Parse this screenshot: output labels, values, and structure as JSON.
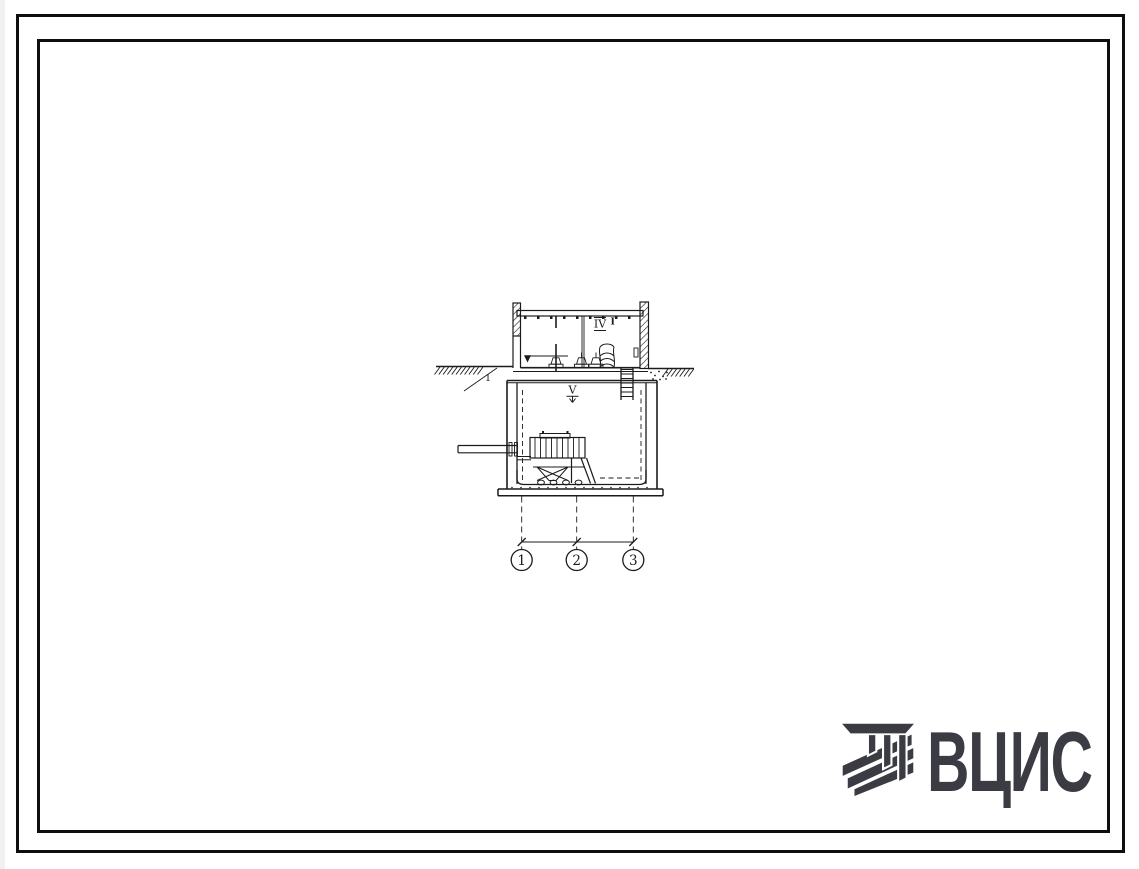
{
  "sheet": {
    "background": "#ffffff",
    "ink": "#1b1b1b",
    "frame_color": "#0e0e0e"
  },
  "drawing": {
    "labels": {
      "room_mark": "IV",
      "room_mark_index": "I",
      "floor_mark": "V",
      "ground_item": "1"
    },
    "axis_bubbles": [
      {
        "label": "1"
      },
      {
        "label": "2"
      },
      {
        "label": "3"
      }
    ]
  },
  "logo": {
    "text": "ВЦИС",
    "color": "#3b3b43"
  }
}
